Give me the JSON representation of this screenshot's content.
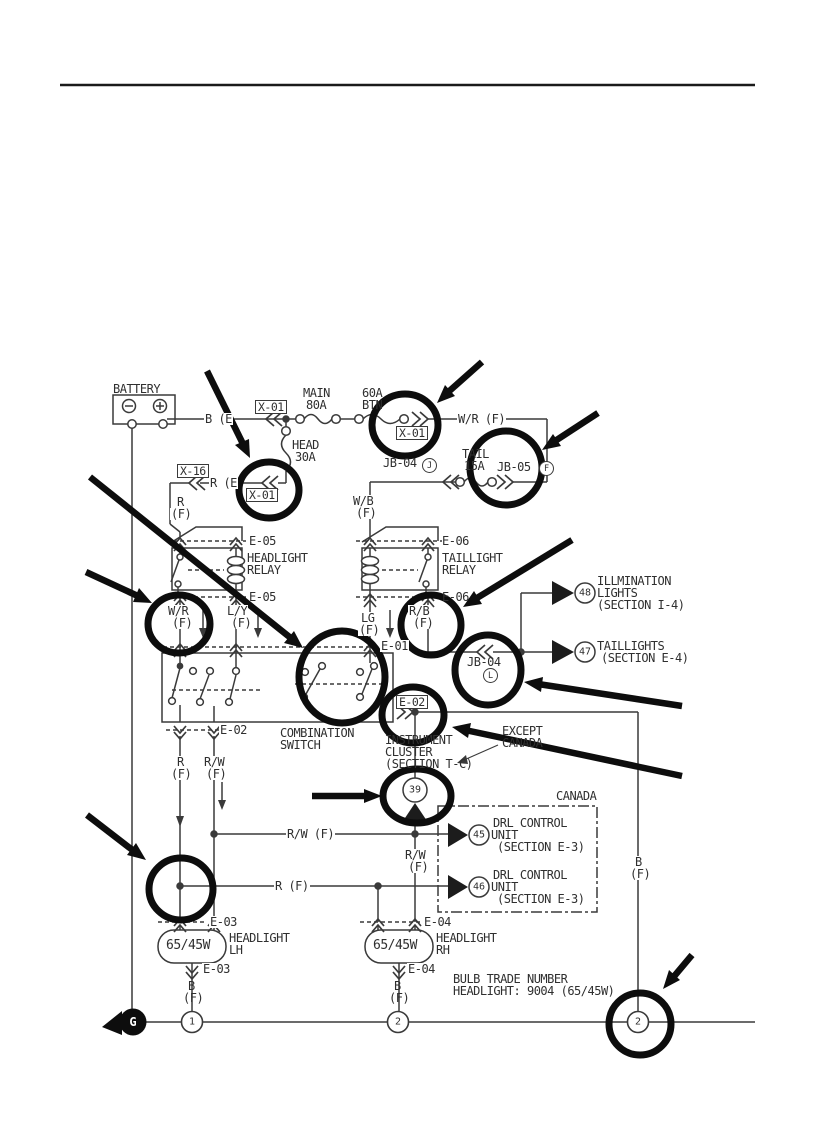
{
  "battery": {
    "label": "BATTERY"
  },
  "fuses": {
    "main1": "MAIN",
    "main2": "80A",
    "btn1": "60A",
    "btn2": "BTN",
    "head1": "HEAD",
    "head2": "30A",
    "tail1": "TAIL",
    "tail2": "15A"
  },
  "connectors": {
    "x01_top": "X-01",
    "x01_right": "X-01",
    "x01_mid": "X-01",
    "x16": "X-16",
    "jb04_top": "JB-04",
    "jb04_top_letter": "J",
    "jb05": "JB-05",
    "jb05_letter": "F",
    "jb04_mid": "JB-04",
    "jb04_mid_letter": "L",
    "e05_top": "E-05",
    "e05_bot": "E-05",
    "e06_top": "E-06",
    "e06_bot": "E-06",
    "e01": "E-01",
    "e02_left": "E-02",
    "e02_right": "E-02",
    "e03_top": "E-03",
    "e03_bot": "E-03",
    "e04_top": "E-04",
    "e04_bot": "E-04"
  },
  "wires": {
    "b_e": "B (E",
    "r_e": "R (E",
    "wr_top": "W/R (F)",
    "wb1": "W/B",
    "wb2": "(F)",
    "r1": "R",
    "r2": "(F)",
    "wr1": "W/R",
    "wr2": "(F)",
    "ly1": "L/Y",
    "ly2": "(F)",
    "lg1": "LG",
    "lg2": "(F)",
    "rb1": "R/B",
    "rb2": "(F)",
    "r_mid1": "R",
    "r_mid2": "(F)",
    "rw_mid1": "R/W",
    "rw_mid2": "(F)",
    "rw_h": "R/W (F)",
    "rw_v1": "R/W",
    "rw_v2": "(F)",
    "r_h": "R (F)",
    "b_right1": "B",
    "b_right2": "(F)",
    "b_lh1": "B",
    "b_lh2": "(F)",
    "b_rh1": "B",
    "b_rh2": "(F)"
  },
  "relays": {
    "headlight1": "HEADLIGHT",
    "headlight2": "RELAY",
    "taillight1": "TAILLIGHT",
    "taillight2": "RELAY"
  },
  "comb_switch": {
    "l1": "COMBINATION",
    "l2": "SWITCH"
  },
  "cluster": {
    "l1": "INSTRUMENT",
    "l2": "CLUSTER",
    "l3": "(SECTION T-C)"
  },
  "regions": {
    "except1": "EXCEPT",
    "except2": "CANADA",
    "canada": "CANADA"
  },
  "dest": {
    "d48": {
      "num": "48",
      "l1": "ILLMINATION",
      "l2": "LIGHTS",
      "l3": "(SECTION I-4)"
    },
    "d47": {
      "num": "47",
      "l1": "TAILLIGHTS",
      "l2": "(SECTION E-4)"
    },
    "d45": {
      "num": "45",
      "l1": "DRL CONTROL",
      "l2": "UNIT",
      "l3": "(SECTION E-3)"
    },
    "d46": {
      "num": "46",
      "l1": "DRL CONTROL",
      "l2": "UNIT",
      "l3": "(SECTION E-3)"
    },
    "d39": {
      "num": "39"
    }
  },
  "bulbs": {
    "lh_w": "65/45W",
    "lh1": "HEADLIGHT",
    "lh2": "LH",
    "rh_w": "65/45W",
    "rh1": "HEADLIGHT",
    "rh2": "RH"
  },
  "note": {
    "l1": "BULB TRADE NUMBER",
    "l2": "HEADLIGHT: 9004 (65/45W)"
  },
  "ground": {
    "g": "G",
    "p1": "1",
    "p2": "2",
    "p3": "2"
  },
  "colors": {
    "ink": "#3a3a3a",
    "annotation": "#0d0d0d",
    "paper": "#ffffff"
  }
}
